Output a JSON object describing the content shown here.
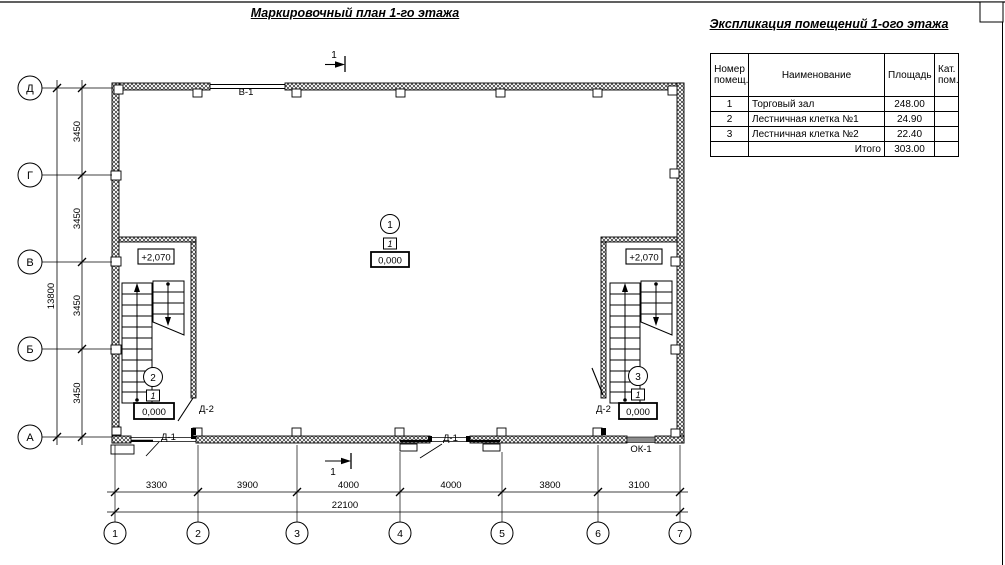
{
  "page": {
    "title": "Маркировочный план 1-го этажа"
  },
  "explication": {
    "title": "Экспликация помещений 1-ого этажа",
    "headers": {
      "num": "Номер помещ.",
      "name": "Наименование",
      "area": "Площадь",
      "cat": "Кат. пом."
    },
    "rows": [
      {
        "num": "1",
        "name": "Торговый зал",
        "area": "248.00",
        "cat": ""
      },
      {
        "num": "2",
        "name": "Лестничная клетка №1",
        "area": "24.90",
        "cat": ""
      },
      {
        "num": "3",
        "name": "Лестничная клетка №2",
        "area": "22.40",
        "cat": ""
      }
    ],
    "total_label": "Итого",
    "total_value": "303.00"
  },
  "plan": {
    "axis_rows": [
      "Д",
      "Г",
      "В",
      "Б",
      "А"
    ],
    "axis_cols": [
      "1",
      "2",
      "3",
      "4",
      "5",
      "6",
      "7"
    ],
    "dim_row_segments": [
      "3450",
      "3450",
      "3450",
      "3450"
    ],
    "dim_row_total": "13800",
    "dim_col_segments": [
      "3300",
      "3900",
      "4000",
      "4000",
      "3800",
      "3100"
    ],
    "dim_col_total": "22100",
    "marks": {
      "window_top": "В-1",
      "window_bottom": "ОК-1",
      "door_exterior": "Д-1",
      "door_interior": "Д-2",
      "level_upper": "+2,070",
      "level_zero": "0,000",
      "floor_type": "1",
      "section": "1"
    },
    "rooms": {
      "hall": "1",
      "stair1": "2",
      "stair2": "3"
    }
  }
}
